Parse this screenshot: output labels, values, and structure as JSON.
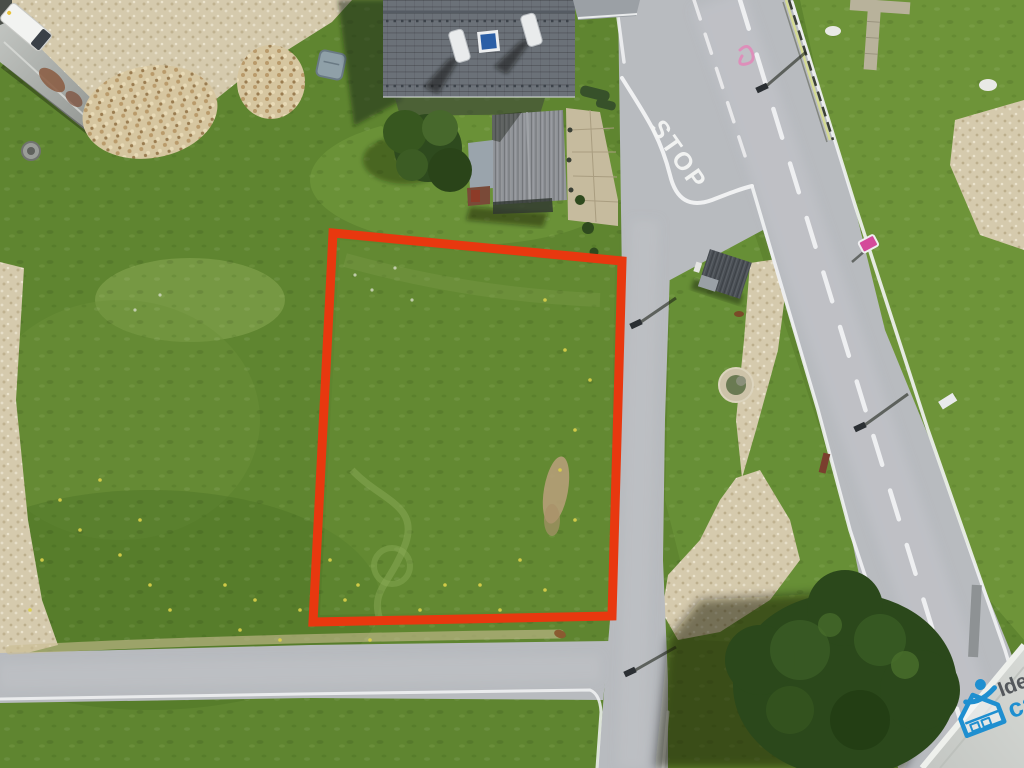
{
  "road_markings": {
    "stop": "STOP"
  },
  "watermark": {
    "line1": "Ide",
    "line2": "ca"
  },
  "colors": {
    "grass_base": "#5f8530",
    "asphalt": "#b8bbbf",
    "plot_outline_red": "#e8380f",
    "house_roof_gray": "#6b7178",
    "skylight_blue": "#2a5ea6",
    "watermark_blue": "#1f8fd0",
    "watermark_text_gray": "#54585c"
  }
}
